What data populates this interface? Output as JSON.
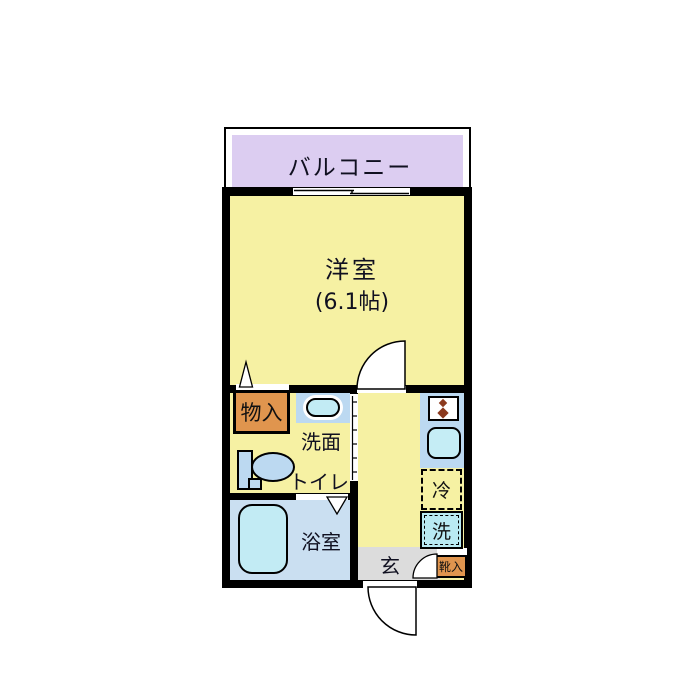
{
  "floorplan": {
    "balcony": {
      "label": "バルコニー"
    },
    "main_room": {
      "label": "洋室",
      "size_label": "(6.1帖)"
    },
    "closet": {
      "label": "物入"
    },
    "washroom": {
      "sink_label": "洗面",
      "toilet_label": "トイレ"
    },
    "bathroom": {
      "label": "浴室"
    },
    "kitchen": {
      "fridge_label": "冷",
      "washer_label": "洗"
    },
    "entrance": {
      "label": "玄",
      "shoebox_label": "靴入"
    },
    "colors": {
      "wall": "#000000",
      "room_yellow": "#f6f1a3",
      "balcony_lavender": "#dccdf1",
      "fixture_blue": "#bcd9f1",
      "fixture_cyan": "#c2ebf4",
      "bathroom_blue": "#cadff1",
      "cabinet_orange": "#e0954e",
      "genkan_gray": "#dcdcdc",
      "burner_brown": "#8b3a1e"
    }
  }
}
